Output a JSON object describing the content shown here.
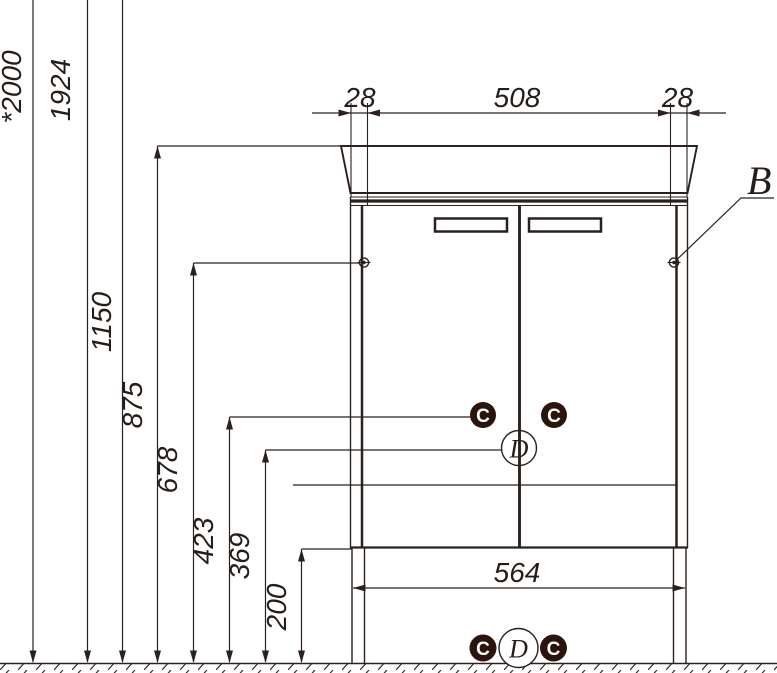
{
  "drawing": {
    "kind": "bathroom vanity cabinet front elevation with installation dimensions",
    "units": "mm"
  },
  "colors": {
    "line": "#2a211c",
    "badge_fill": "#2a140b",
    "paper": "#ffffff"
  },
  "dimensions": {
    "heights": [
      "*2000",
      "1924",
      "1150",
      "875",
      "678",
      "423",
      "369",
      "200"
    ],
    "top_widths": [
      "28",
      "508",
      "28"
    ],
    "bottom_width": "564"
  },
  "callouts": {
    "b": "B",
    "c": "C",
    "d": "D"
  }
}
